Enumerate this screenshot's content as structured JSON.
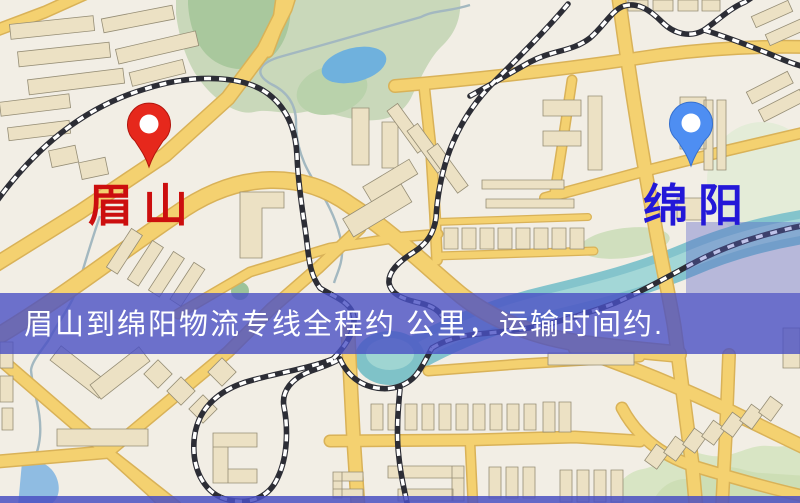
{
  "banner": {
    "text": "眉山到绵阳物流专线全程约 公里，运输时间约.",
    "bg_color": "#4a50c4",
    "text_color": "#ffffff"
  },
  "origin_marker": {
    "label": "眉山",
    "icon": "map-pin-icon",
    "pin_color": "#e6281c",
    "label_color": "#cc0e0e"
  },
  "destination_marker": {
    "label": "绵阳",
    "icon": "map-pin-icon",
    "pin_color": "#4e8ef2",
    "label_color": "#2318d8"
  },
  "map_colors": {
    "background": "#f2eee5",
    "road_fill": "#f4d170",
    "road_casing": "#d9b258",
    "park_green": "#c9d8ba",
    "water_blue": "#84c4cc",
    "pond_blue": "#6fb1dd",
    "building": "#ece1c4",
    "railway_dark": "#2c2d35",
    "overlay_tint": "#5860c8"
  }
}
